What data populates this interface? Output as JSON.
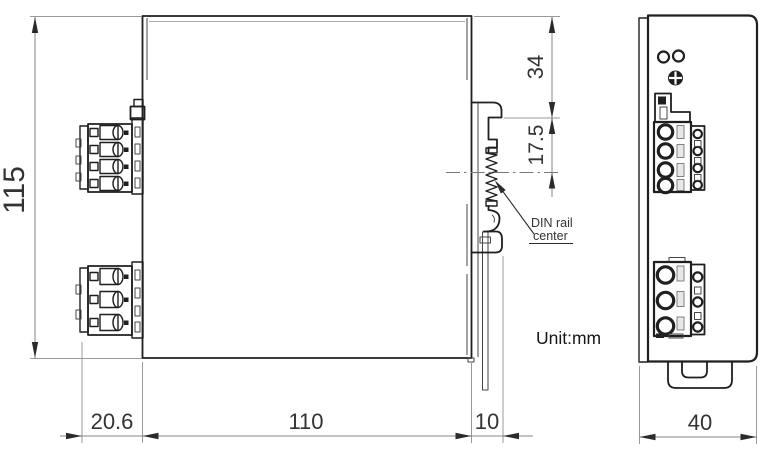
{
  "drawing": {
    "unit_label": "Unit:mm",
    "annotations": {
      "din_rail_line1": "DIN rail",
      "din_rail_line2": "center"
    },
    "dimensions": {
      "overall_height_mm": "115",
      "top_to_clip_mm": "34",
      "clip_to_rail_center_mm": "17.5",
      "terminal_depth_mm": "20.6",
      "body_depth_mm": "110",
      "clip_protrusion_mm": "10",
      "body_width_mm": "40"
    },
    "colors": {
      "outline": "#1f1f1f",
      "dimension_lines": "#848484",
      "text": "#333333",
      "background": "#ffffff"
    }
  }
}
